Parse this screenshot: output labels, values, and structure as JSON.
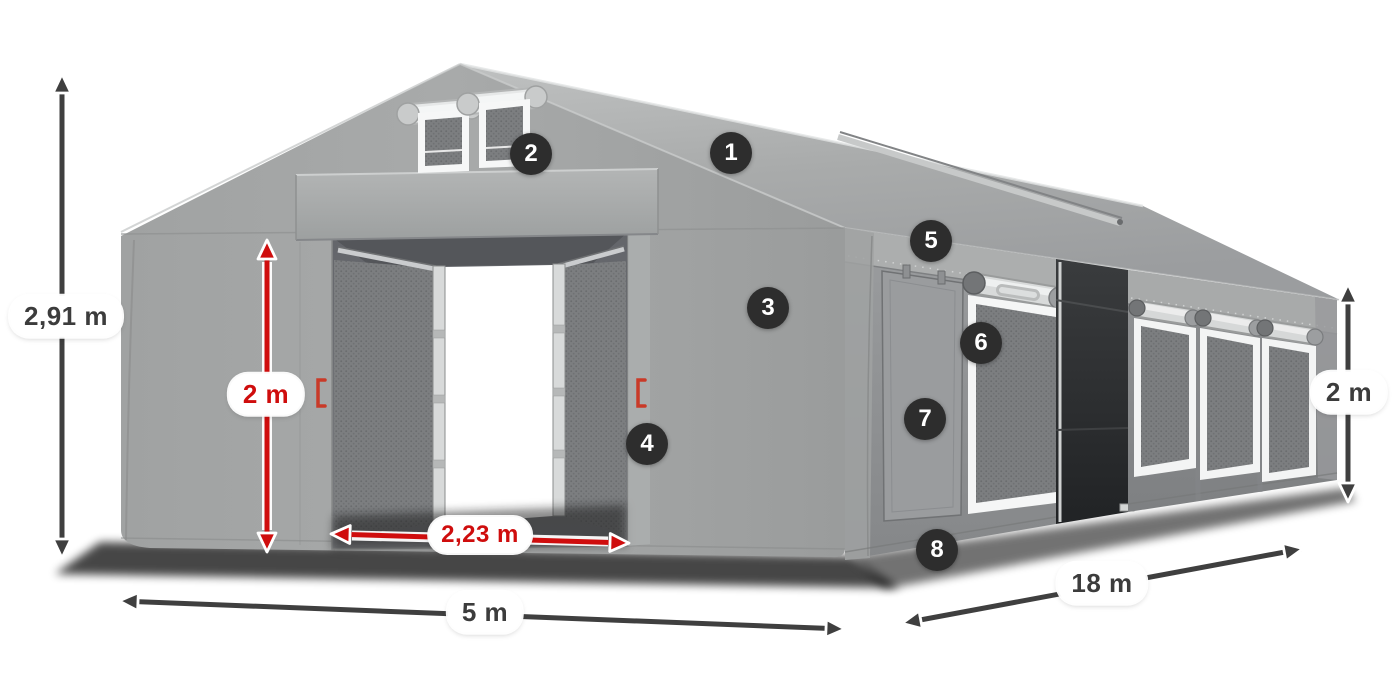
{
  "dimensions": {
    "total_height": {
      "label": "2,91 m",
      "style": "dark"
    },
    "entrance_height": {
      "label": "2 m",
      "style": "red"
    },
    "entrance_width": {
      "label": "2,23 m",
      "style": "red"
    },
    "width": {
      "label": "5 m",
      "style": "dark"
    },
    "length": {
      "label": "18 m",
      "style": "dark"
    },
    "side_height": {
      "label": "2 m",
      "style": "dark"
    }
  },
  "callouts": [
    {
      "number": "1"
    },
    {
      "number": "2"
    },
    {
      "number": "3"
    },
    {
      "number": "4"
    },
    {
      "number": "5"
    },
    {
      "number": "6"
    },
    {
      "number": "7"
    },
    {
      "number": "8"
    }
  ],
  "colors": {
    "accent_red": "#cf0d0d",
    "arrow_dark": "#3f3f3f",
    "badge_background": "#2d2d2d",
    "badge_text": "#ffffff",
    "label_background": "#ffffff",
    "label_text": "#3c3c3c",
    "tent_gray": "#9b9d9d",
    "roof_gray": "#b0b2b2"
  }
}
